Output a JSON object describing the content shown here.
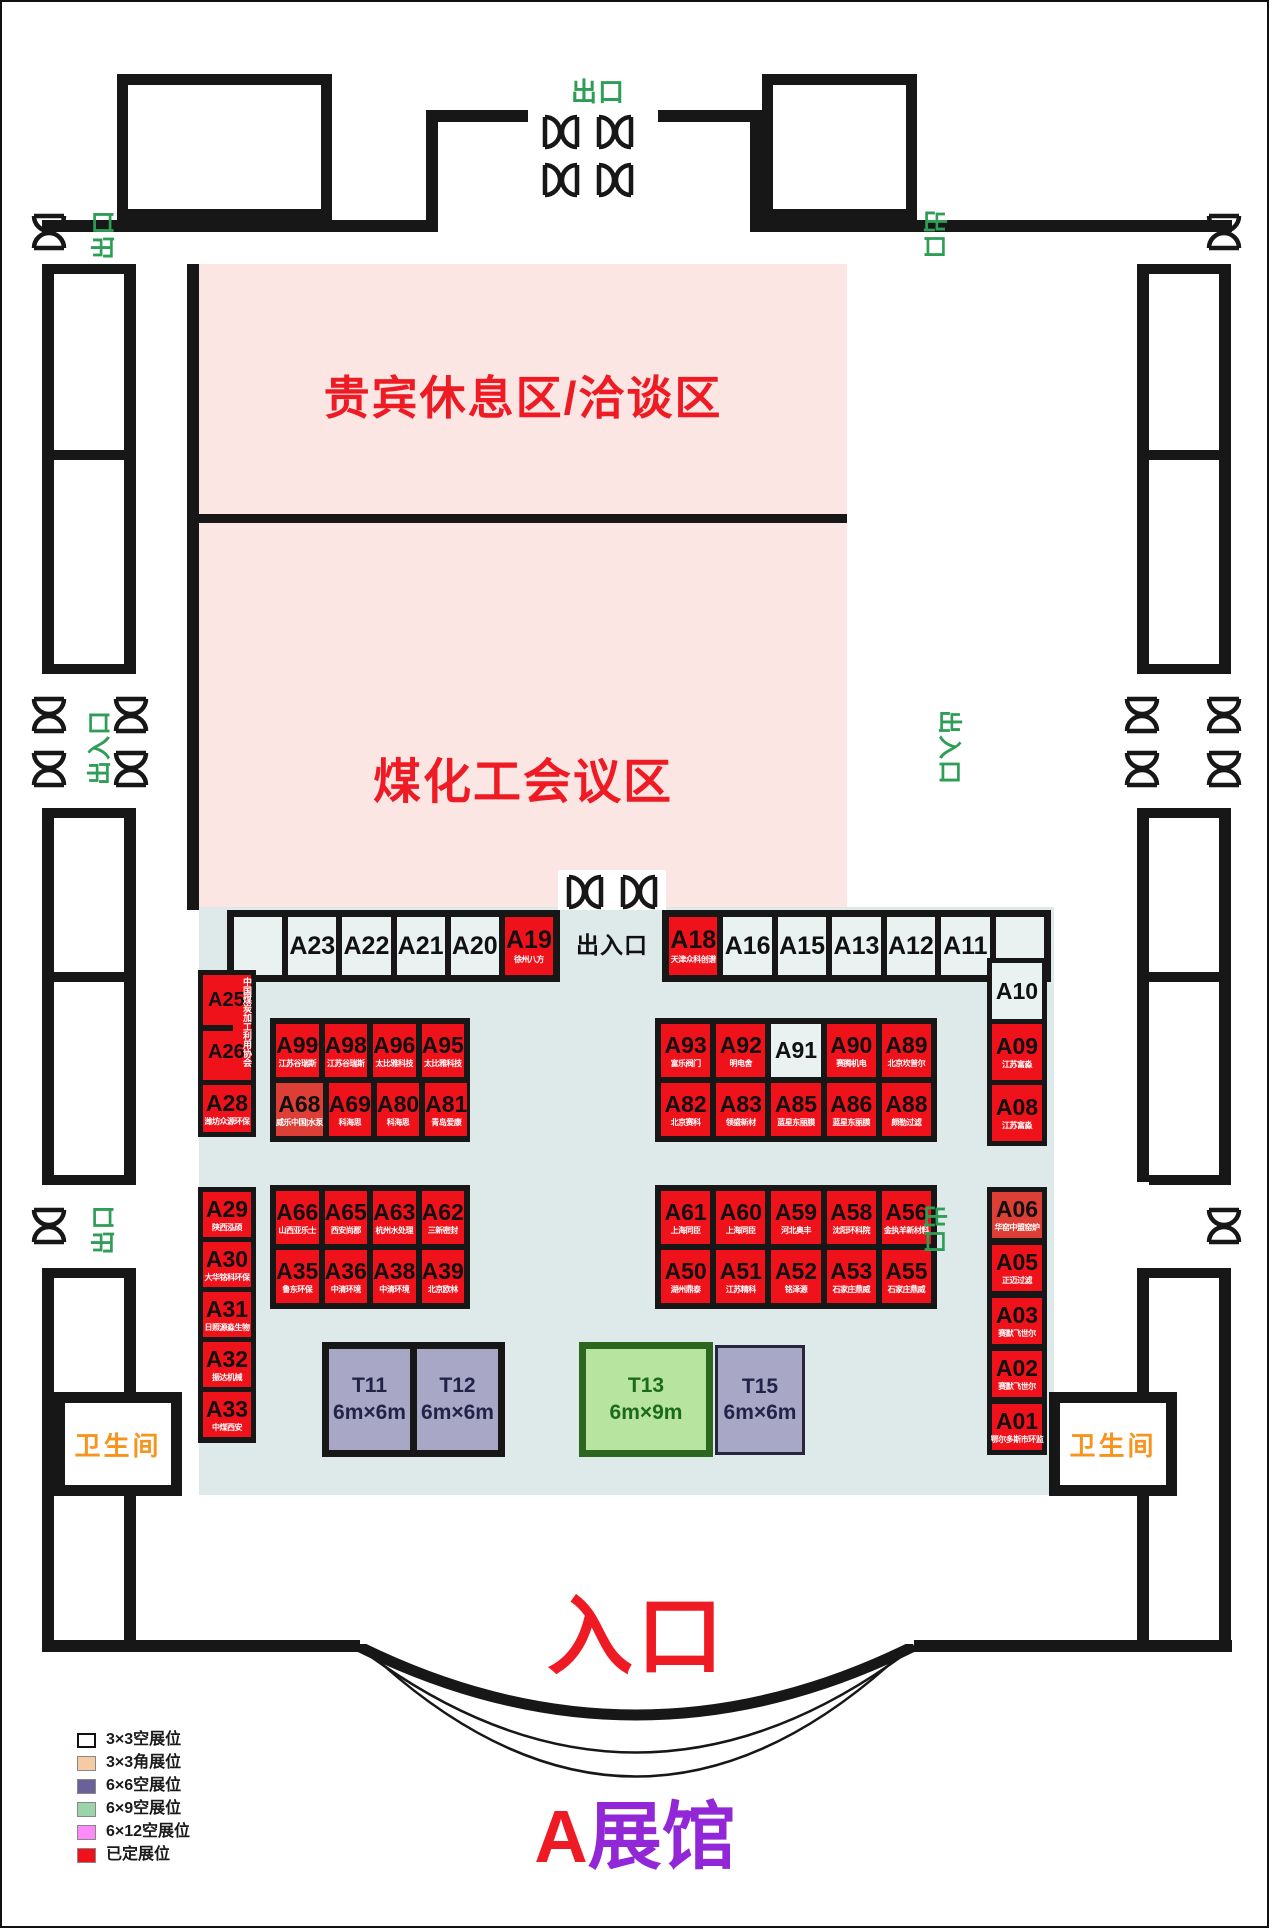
{
  "hall": {
    "title_prefix": "A",
    "title_suffix": "展馆",
    "entrance_label": "入口",
    "exit_label": "出口",
    "entrance_exit_label": "出入口",
    "restroom_label": "卫生间",
    "vip_area_label": "贵宾休息区/洽谈区",
    "conference_area_label": "煤化工会议区"
  },
  "legend": {
    "items": [
      {
        "label": "3×3空展位",
        "color": "#FFFFFF"
      },
      {
        "label": "3×3角展位",
        "color": "#F5CBA3"
      },
      {
        "label": "6×6空展位",
        "color": "#6A6198"
      },
      {
        "label": "6×9空展位",
        "color": "#9CD3A8"
      },
      {
        "label": "6×12空展位",
        "color": "#FB8BF7"
      },
      {
        "label": "已定展位",
        "color": "#F0121B"
      }
    ]
  },
  "booths": {
    "top_row_left": [
      {
        "id": "",
        "type": "empty"
      },
      {
        "id": "A23",
        "type": "empty"
      },
      {
        "id": "A22",
        "type": "empty"
      },
      {
        "id": "A21",
        "type": "empty"
      },
      {
        "id": "A20",
        "type": "empty"
      },
      {
        "id": "A19",
        "type": "sold",
        "company": "徐州八方"
      }
    ],
    "top_row_right": [
      {
        "id": "A18",
        "type": "sold",
        "company": "天津众科创谱"
      },
      {
        "id": "A16",
        "type": "empty"
      },
      {
        "id": "A15",
        "type": "empty"
      },
      {
        "id": "A13",
        "type": "empty"
      },
      {
        "id": "A12",
        "type": "empty"
      },
      {
        "id": "A11",
        "type": "empty"
      },
      {
        "id": "",
        "type": "empty"
      }
    ],
    "left_top": {
      "a25": "A25",
      "a26": "A26",
      "side_text": "中国煤炭加工利用协会",
      "a28_id": "A28",
      "a28_company": "潍坊众源环保"
    },
    "left_bottom": [
      {
        "id": "A29",
        "type": "sold",
        "company": "陕西泓硕"
      },
      {
        "id": "A30",
        "type": "sold",
        "company": "大华铭科环保"
      },
      {
        "id": "A31",
        "type": "sold",
        "company": "日照源淼生物"
      },
      {
        "id": "A32",
        "type": "sold",
        "company": "振达机械"
      },
      {
        "id": "A33",
        "type": "sold",
        "company": "中煤西安"
      }
    ],
    "mid_left_top": [
      [
        {
          "id": "A99",
          "type": "sold",
          "company": "江苏谷瑞斯"
        },
        {
          "id": "A98",
          "type": "sold",
          "company": "江苏谷瑞斯"
        },
        {
          "id": "A96",
          "type": "sold",
          "company": "太比雅科技"
        },
        {
          "id": "A95",
          "type": "sold",
          "company": "太比雅科技"
        }
      ],
      [
        {
          "id": "A68",
          "type": "sold-alt",
          "company": "威乐中国|水泵"
        },
        {
          "id": "A69",
          "type": "sold",
          "company": "科海思"
        },
        {
          "id": "A80",
          "type": "sold",
          "company": "科海思"
        },
        {
          "id": "A81",
          "type": "sold",
          "company": "青岛爱康"
        }
      ]
    ],
    "mid_right_top": [
      [
        {
          "id": "A93",
          "type": "sold",
          "company": "富乐阀门"
        },
        {
          "id": "A92",
          "type": "sold",
          "company": "明电舍"
        },
        {
          "id": "A91",
          "type": "empty"
        },
        {
          "id": "A90",
          "type": "sold",
          "company": "赛腾机电"
        },
        {
          "id": "A89",
          "type": "sold",
          "company": "北京坎普尔"
        }
      ],
      [
        {
          "id": "A82",
          "type": "sold",
          "company": "北京赛科"
        },
        {
          "id": "A83",
          "type": "sold",
          "company": "领盛新材"
        },
        {
          "id": "A85",
          "type": "sold",
          "company": "蓝星东丽膜"
        },
        {
          "id": "A86",
          "type": "sold",
          "company": "蓝星东丽膜"
        },
        {
          "id": "A88",
          "type": "sold",
          "company": "颇勒过滤"
        }
      ]
    ],
    "mid_left_bottom": [
      [
        {
          "id": "A66",
          "type": "sold",
          "company": "山西亚乐士"
        },
        {
          "id": "A65",
          "type": "sold",
          "company": "西安尚郡"
        },
        {
          "id": "A63",
          "type": "sold",
          "company": "杭州水处理"
        },
        {
          "id": "A62",
          "type": "sold",
          "company": "三新密封"
        }
      ],
      [
        {
          "id": "A35",
          "type": "sold",
          "company": "鲁东环保"
        },
        {
          "id": "A36",
          "type": "sold",
          "company": "中清环境"
        },
        {
          "id": "A38",
          "type": "sold",
          "company": "中清环境"
        },
        {
          "id": "A39",
          "type": "sold",
          "company": "北京欧林"
        }
      ]
    ],
    "mid_right_bottom": [
      [
        {
          "id": "A61",
          "type": "sold",
          "company": "上海同臣"
        },
        {
          "id": "A60",
          "type": "sold",
          "company": "上海同臣"
        },
        {
          "id": "A59",
          "type": "sold",
          "company": "河北奥丰"
        },
        {
          "id": "A58",
          "type": "sold",
          "company": "沈阳环科院"
        },
        {
          "id": "A56",
          "type": "sold",
          "company": "金执羊新材料"
        }
      ],
      [
        {
          "id": "A50",
          "type": "sold",
          "company": "湖州鼎泰"
        },
        {
          "id": "A51",
          "type": "sold",
          "company": "江苏精科"
        },
        {
          "id": "A52",
          "type": "sold",
          "company": "铭泽源"
        },
        {
          "id": "A53",
          "type": "sold",
          "company": "石家庄鼎威"
        },
        {
          "id": "A55",
          "type": "sold",
          "company": "石家庄鼎威"
        }
      ]
    ],
    "right_top": [
      {
        "id": "A10",
        "type": "empty"
      },
      {
        "id": "A09",
        "type": "sold",
        "company": "江苏富淼"
      },
      {
        "id": "A08",
        "type": "sold",
        "company": "江苏富淼"
      }
    ],
    "right_bottom": [
      {
        "id": "A06",
        "type": "sold-alt",
        "company": "华窑中盟窑炉"
      },
      {
        "id": "A05",
        "type": "sold",
        "company": "正迈过滤"
      },
      {
        "id": "A03",
        "type": "sold",
        "company": "赛默飞世尔"
      },
      {
        "id": "A02",
        "type": "sold",
        "company": "赛默飞世尔"
      },
      {
        "id": "A01",
        "type": "sold",
        "company": "鄂尔多斯市环监"
      }
    ],
    "t_booths": [
      {
        "id": "T11",
        "size": "6m×6m"
      },
      {
        "id": "T12",
        "size": "6m×6m"
      },
      {
        "id": "T13",
        "size": "6m×9m"
      },
      {
        "id": "T15",
        "size": "6m×6m"
      }
    ]
  }
}
